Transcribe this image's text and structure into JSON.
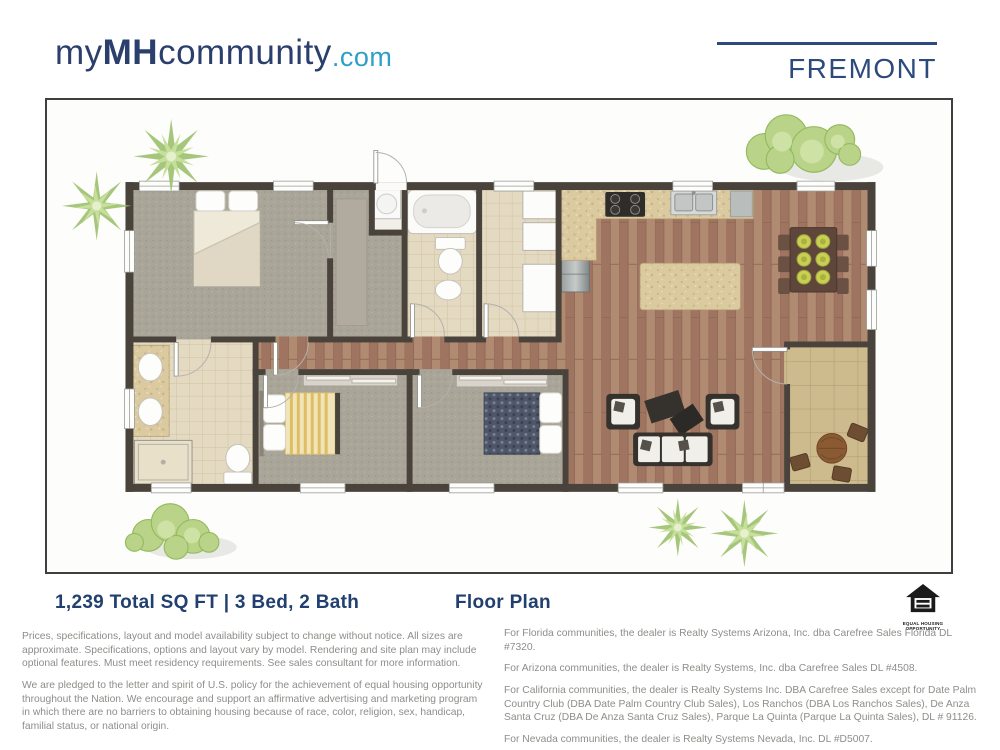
{
  "header": {
    "logo": {
      "part1": "my",
      "part2": "MH",
      "part3": "community",
      "part4": ".com"
    },
    "model_name": "FREMONT"
  },
  "summary": {
    "specs": "1,239 Total SQ FT | 3 Bed, 2 Bath",
    "view_label": "Floor Plan"
  },
  "equal_housing": {
    "line1": "EQUAL HOUSING",
    "line2": "OPPORTUNITY"
  },
  "disclaimers": {
    "left": [
      "Prices, specifications, layout and model availability subject to change without notice. All sizes are approximate. Specifications, options and layout vary by model. Rendering and site plan may include optional features. Must meet residency requirements. See sales consultant for more information.",
      "We are pledged to the letter and spirit of U.S. policy for the achievement of equal housing opportunity throughout the Nation. We encourage and support an affirmative advertising and marketing program in which there are no barriers to obtaining housing because of race, color, religion, sex, handicap, familial status, or national origin."
    ],
    "right": [
      "For Florida communities, the dealer is Realty Systems Arizona, Inc. dba Carefree Sales Florida DL #7320.",
      "For Arizona communities, the dealer is Realty Systems, Inc. dba Carefree Sales DL #4508.",
      "For California communities, the dealer is Realty Systems Inc. DBA Carefree Sales except for Date Palm Country Club (DBA Date Palm Country Club Sales), Los Ranchos (DBA Los Ranchos Sales), De Anza Santa Cruz (DBA De Anza Santa Cruz Sales), Parque La Quinta (Parque La Quinta Sales), DL # 91126.",
      "For Nevada communities, the dealer is Realty Systems Nevada, Inc. DL #D5007."
    ]
  },
  "colors": {
    "brand_navy": "#2b3f6d",
    "accent_blue": "#2f9fc7",
    "wall": "#49433c",
    "wood_floor": "#a87f67",
    "carpet": "#aaa599",
    "tile": "#e4dac2",
    "patio_tile": "#cdbb8e",
    "foliage_green": "#b9d489"
  }
}
